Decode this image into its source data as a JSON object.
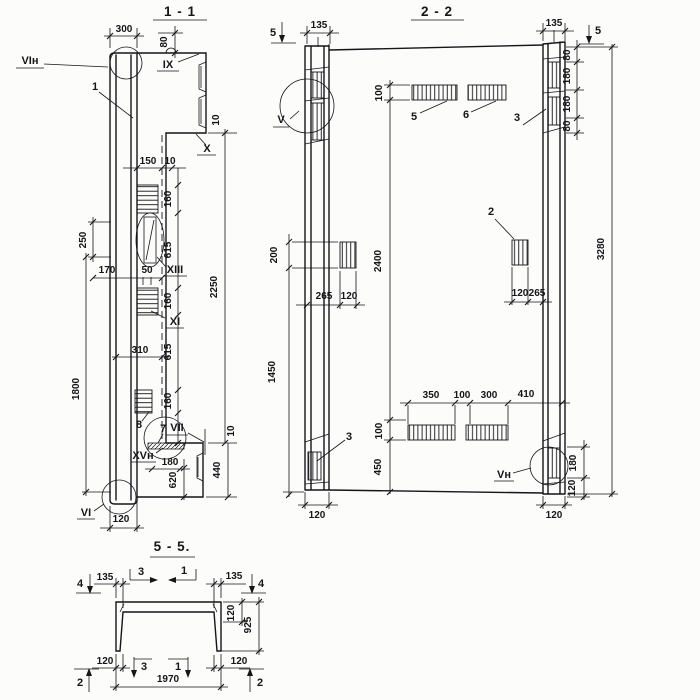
{
  "s1": {
    "title": "1 - 1",
    "callouts": {
      "vi_top": "VIн",
      "c1": "1",
      "ix": "IX",
      "x": "X",
      "xiii": "XIII",
      "xi": "XI",
      "c8": "8",
      "c7": "7",
      "vii": "VII",
      "xv": "XVн",
      "vi_bot": "VI"
    },
    "dims": {
      "d300": "300",
      "d80": "80",
      "d10x": "10",
      "d150": "150",
      "d10r": "10",
      "d160a": "160",
      "d615a": "615",
      "d160b": "160",
      "d615b": "615",
      "d160c": "160",
      "d2250": "2250",
      "d250": "250",
      "d170": "170",
      "d50": "50",
      "d310": "310",
      "d1800": "1800",
      "d10v": "10",
      "d440": "440",
      "d180": "180",
      "d620": "620",
      "d120": "120"
    }
  },
  "s2": {
    "title": "2 - 2",
    "callouts": {
      "v": "V",
      "c5": "5",
      "c6": "6",
      "c3t": "3",
      "c2": "2",
      "c3b": "3",
      "vn": "Vн"
    },
    "marks": {
      "s5l": "5",
      "s5r": "5"
    },
    "dims": {
      "d135l": "135",
      "d135r": "135",
      "d100t": "100",
      "d80a": "80",
      "d180a": "180",
      "d180b": "180",
      "d80b": "80",
      "d3280": "3280",
      "d200": "200",
      "d1450": "1450",
      "d2400": "2400",
      "d265l": "265",
      "d120l": "120",
      "d120r": "120",
      "d265r": "265",
      "d350": "350",
      "d100m": "100",
      "d300": "300",
      "d410": "410",
      "d100b": "100",
      "d450": "450",
      "d180r": "180",
      "d120rb": "120",
      "d120pl": "120",
      "d120pr": "120"
    }
  },
  "s5": {
    "title": "5 - 5.",
    "marks": {
      "s4l": "4",
      "s4r": "4",
      "s3t": "3",
      "s1t": "1",
      "s3b": "3",
      "s1b": "1",
      "s2l": "2",
      "s2r": "2"
    },
    "dims": {
      "d135l": "135",
      "d135r": "135",
      "d120t": "120",
      "d925": "925",
      "d120bl": "120",
      "d120br": "120",
      "d1970": "1970"
    }
  }
}
